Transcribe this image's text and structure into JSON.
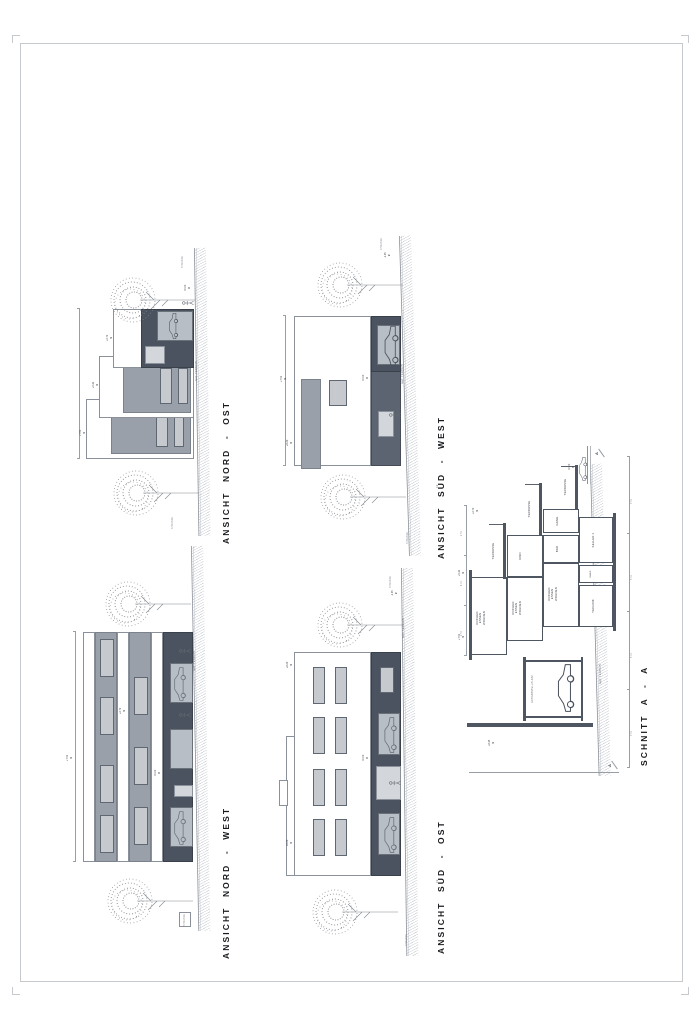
{
  "labels": {
    "nat_terrain": "NAT. TERRAIN",
    "strasse": "STRASSE",
    "section_marker": "A"
  },
  "levels": {
    "l0": "±0.00",
    "l1": "+2.72",
    "l2": "+5.41",
    "l3": "+7.51",
    "l4": "+8.45",
    "l6": "+6.23",
    "lm": "-1.35"
  },
  "dims": {
    "d_a": "2.51",
    "d_b": "4.01",
    "d_c": "2.51",
    "b1": "3.51",
    "b2": "5.01",
    "b3": "5.01",
    "b4": "3.51"
  },
  "drawings": {
    "nord_west": {
      "title": "ANSICHT NORD - WEST"
    },
    "nord_ost": {
      "title": "ANSICHT NORD - OST"
    },
    "sued_ost": {
      "title": "ANSICHT SÜD - OST"
    },
    "sued_west": {
      "title": "ANSICHT SÜD - WEST"
    },
    "schnitt": {
      "title": "SCHNITT A - A",
      "rooms": {
        "kew": "KOCHEN\nESSEN\nWOHNEN",
        "terrasse": "TERRASSE",
        "kind": "KIND",
        "bad": "BAD",
        "gang": "GANG",
        "technik": "TECHNIK",
        "keller": "KELLER 1",
        "autoabstellplatz": "AUTOABSTELLPLATZ"
      }
    }
  },
  "colors": {
    "facade_dark": "#4b5360",
    "facade_gray": "#99a0a9",
    "window": "#c6cacf",
    "linework": "#8b919a",
    "text": "#17191c"
  }
}
